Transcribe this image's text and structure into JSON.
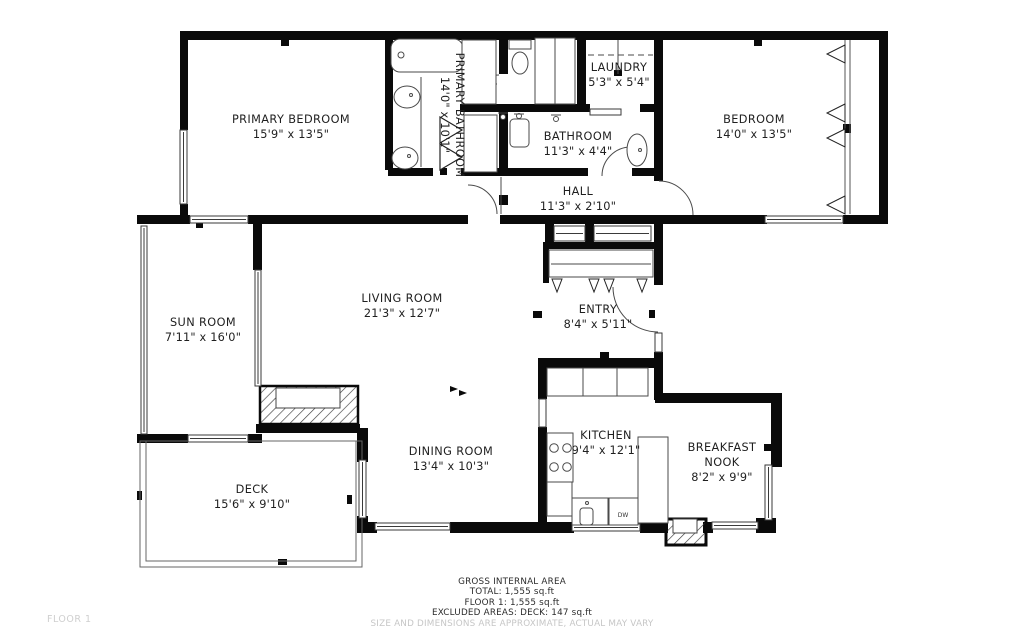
{
  "rooms": {
    "primary_bedroom": {
      "name": "PRIMARY BEDROOM",
      "dims": "15'9\" x 13'5\""
    },
    "primary_bathroom": {
      "name": "PRIMARY BATHROOM",
      "dims": "14'0\" x 10'1\""
    },
    "laundry": {
      "name": "LAUNDRY",
      "dims": "5'3\" x 5'4\""
    },
    "bathroom": {
      "name": "BATHROOM",
      "dims": "11'3\" x 4'4\""
    },
    "hall": {
      "name": "HALL",
      "dims": "11'3\" x 2'10\""
    },
    "bedroom": {
      "name": "BEDROOM",
      "dims": "14'0\" x 13'5\""
    },
    "sun_room": {
      "name": "SUN ROOM",
      "dims": "7'11\" x 16'0\""
    },
    "living_room": {
      "name": "LIVING ROOM",
      "dims": "21'3\" x 12'7\""
    },
    "entry": {
      "name": "ENTRY",
      "dims": "8'4\" x 5'11\""
    },
    "dining_room": {
      "name": "DINING ROOM",
      "dims": "13'4\" x 10'3\""
    },
    "kitchen": {
      "name": "KITCHEN",
      "dims": "9'4\" x 12'1\""
    },
    "breakfast_nook": {
      "name": "BREAKFAST NOOK",
      "dims": "8'2\" x 9'9\""
    },
    "deck": {
      "name": "DECK",
      "dims": "15'6\" x 9'10\""
    }
  },
  "fixtures": {
    "dishwasher_label": "DW"
  },
  "footer": {
    "line1": "GROSS INTERNAL AREA",
    "line2": "TOTAL: 1,555 sq.ft",
    "line3": "FLOOR 1: 1,555 sq.ft",
    "line4": "EXCLUDED AREAS: DECK: 147 sq.ft",
    "disclaimer": "SIZE AND DIMENSIONS ARE APPROXIMATE, ACTUAL MAY VARY"
  },
  "floor_label": "FLOOR 1",
  "colors": {
    "wall": "#0a0a0a",
    "thin_line": "#555555",
    "label_text": "#1f1f1f",
    "muted_text": "#c6c6c6"
  }
}
